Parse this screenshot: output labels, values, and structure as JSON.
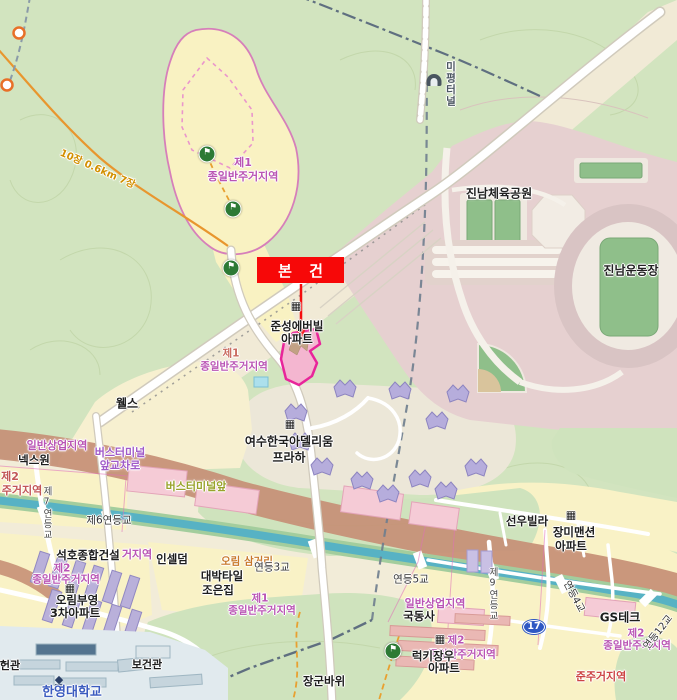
{
  "annotation": {
    "label": "본 건"
  },
  "map": {
    "colors": {
      "callout_red": "#f70808",
      "parcel_highlight_fill": "#f4b6d0",
      "parcel_highlight_border": "#e8259a",
      "zone_label_pink": "#b954b4",
      "commercial_band_brown": "#c69076",
      "stream_teal": "#57b2c4",
      "route_badge_blue": "#2f58c3",
      "forest_green": "#d2e4bf",
      "park_pink": "#e6d0d0"
    },
    "icons": {
      "flag": "⚑",
      "building": "▦",
      "tunnel": "",
      "school": "◆"
    },
    "route_badge": {
      "text": "17",
      "x": 534,
      "y": 627
    },
    "labels": [
      {
        "n": "zone-label",
        "t": "제1",
        "x": 243,
        "y": 163,
        "s": 11,
        "c": "#b954b4",
        "b": 1
      },
      {
        "n": "zone-label",
        "t": "종일반주거지역",
        "x": 243,
        "y": 177,
        "s": 11,
        "c": "#b954b4",
        "b": 1
      },
      {
        "n": "poi-jinnam-sports-park",
        "t": "진남체육공원",
        "x": 499,
        "y": 194,
        "s": 12,
        "c": "#222",
        "b": 1
      },
      {
        "n": "poi-jinnam-stadium",
        "t": "진남운동장",
        "x": 631,
        "y": 271,
        "s": 12,
        "c": "#222",
        "b": 1
      },
      {
        "n": "road-mipyeong-tunnel",
        "t": "미평터널",
        "x": 450,
        "y": 84,
        "s": 10.5,
        "c": "#4a5560",
        "b": 1,
        "v": 1
      },
      {
        "n": "trail-distance-label",
        "t": "10장 0.6km 7장",
        "x": 97,
        "y": 170,
        "s": 10,
        "c": "#d29000",
        "b": 1,
        "r": 24
      },
      {
        "n": "poi-junseong-everville",
        "t": "준성에버빌",
        "x": 297,
        "y": 326,
        "s": 11.5,
        "c": "#1d1d1d",
        "b": 1
      },
      {
        "n": "poi-junseong-everville",
        "t": "아파트",
        "x": 297,
        "y": 339,
        "s": 11.5,
        "c": "#1d1d1d",
        "b": 1
      },
      {
        "n": "zone-label",
        "t": "제1",
        "x": 231,
        "y": 354,
        "s": 10.5,
        "c": "#c96a5e",
        "b": 1
      },
      {
        "n": "zone-label",
        "t": "종일반주거지역",
        "x": 234,
        "y": 367,
        "s": 10.5,
        "c": "#b954b4",
        "b": 1
      },
      {
        "n": "poi-wells",
        "t": "웰스",
        "x": 127,
        "y": 404,
        "s": 12,
        "c": "#1d1d1d",
        "b": 1
      },
      {
        "n": "poi-adellium-praha",
        "t": "여수한국아델리움",
        "x": 289,
        "y": 442,
        "s": 12,
        "c": "#1d1d1d",
        "b": 1
      },
      {
        "n": "poi-adellium-praha",
        "t": "프라하",
        "x": 289,
        "y": 458,
        "s": 12,
        "c": "#1d1d1d",
        "b": 1
      },
      {
        "n": "zone-label",
        "t": "일반상업지역",
        "x": 57,
        "y": 446,
        "s": 11,
        "c": "#b954b4",
        "b": 1
      },
      {
        "n": "poi-nexone",
        "t": "넥스원",
        "x": 34,
        "y": 460,
        "s": 11.5,
        "c": "#1d1d1d",
        "b": 1
      },
      {
        "n": "intersection-bus-terminal",
        "t": "버스터미널",
        "x": 120,
        "y": 453,
        "s": 11,
        "c": "#a05ac8",
        "b": 1
      },
      {
        "n": "intersection-bus-terminal",
        "t": "앞교차로",
        "x": 120,
        "y": 466,
        "s": 11,
        "c": "#a05ac8",
        "b": 1
      },
      {
        "n": "busstop-bus-terminal-front",
        "t": "버스터미널앞",
        "x": 196,
        "y": 487,
        "s": 11,
        "c": "#99a32b",
        "b": 1
      },
      {
        "n": "zone-label",
        "t": "제2",
        "x": 10,
        "y": 477,
        "s": 11,
        "c": "#c25555",
        "b": 1
      },
      {
        "n": "zone-label",
        "t": "주거지역",
        "x": 22,
        "y": 491,
        "s": 11,
        "c": "#c25555",
        "b": 1
      },
      {
        "n": "bridge-jereyeondeung-6",
        "t": "제6연등교",
        "x": 109,
        "y": 521,
        "s": 10.5,
        "c": "#333"
      },
      {
        "n": "poi-seokho-construction",
        "t": "석호종합건설",
        "x": 88,
        "y": 555,
        "s": 11.5,
        "c": "#1d1d1d",
        "b": 1
      },
      {
        "n": "zone-label",
        "t": "거지역",
        "x": 137,
        "y": 555,
        "s": 11,
        "c": "#b954b4",
        "b": 1
      },
      {
        "n": "poi-incellderm",
        "t": "인셀덤",
        "x": 172,
        "y": 559,
        "s": 11.5,
        "c": "#1d1d1d",
        "b": 1
      },
      {
        "n": "zone-label",
        "t": "제2",
        "x": 62,
        "y": 569,
        "s": 10.5,
        "c": "#b954b4",
        "b": 1
      },
      {
        "n": "zone-label",
        "t": "종일반주거지역",
        "x": 66,
        "y": 580,
        "s": 10.5,
        "c": "#b954b4",
        "b": 1
      },
      {
        "n": "poi-orim-booyoung-apt",
        "t": "오림부영",
        "x": 77,
        "y": 600,
        "s": 11.5,
        "c": "#1d1d1d",
        "b": 1
      },
      {
        "n": "poi-orim-booyoung-apt",
        "t": "3차아파트",
        "x": 75,
        "y": 613,
        "s": 11.5,
        "c": "#1d1d1d",
        "b": 1
      },
      {
        "n": "poi-daebak-tile",
        "t": "대박타일",
        "x": 222,
        "y": 576,
        "s": 11.5,
        "c": "#1d1d1d",
        "b": 1
      },
      {
        "n": "poi-daebak-tile",
        "t": "조은집",
        "x": 218,
        "y": 590,
        "s": 11.5,
        "c": "#1d1d1d",
        "b": 1
      },
      {
        "n": "intersection-orim",
        "t": "오림 삼거리",
        "x": 247,
        "y": 562,
        "s": 10.5,
        "c": "#c87828",
        "b": 1
      },
      {
        "n": "bridge-yeondeung-3",
        "t": "연등3교",
        "x": 272,
        "y": 568,
        "s": 10.5,
        "c": "#333"
      },
      {
        "n": "bridge-yeondeung-5",
        "t": "연등5교",
        "x": 411,
        "y": 580,
        "s": 10.5,
        "c": "#333"
      },
      {
        "n": "zone-label",
        "t": "제1",
        "x": 260,
        "y": 599,
        "s": 10.5,
        "c": "#b954b4",
        "b": 1
      },
      {
        "n": "zone-label",
        "t": "종일반주거지역",
        "x": 262,
        "y": 611,
        "s": 10.5,
        "c": "#b954b4",
        "b": 1
      },
      {
        "n": "zone-label",
        "t": "일반상업지역",
        "x": 435,
        "y": 604,
        "s": 11,
        "c": "#b954b4",
        "b": 1
      },
      {
        "n": "poi-gukdongsa",
        "t": "국동사",
        "x": 419,
        "y": 616,
        "s": 11.5,
        "c": "#1d1d1d",
        "b": 1
      },
      {
        "n": "zone-label",
        "t": "제2",
        "x": 456,
        "y": 641,
        "s": 10.5,
        "c": "#b954b4",
        "b": 1
      },
      {
        "n": "zone-label",
        "t": "종일반주거지역",
        "x": 462,
        "y": 655,
        "s": 10.5,
        "c": "#b954b4",
        "b": 1
      },
      {
        "n": "poi-lucky-apt",
        "t": "럭키장우",
        "x": 433,
        "y": 656,
        "s": 11.5,
        "c": "#1d1d1d",
        "b": 1
      },
      {
        "n": "poi-lucky-apt",
        "t": "아파트",
        "x": 444,
        "y": 668,
        "s": 11.5,
        "c": "#1d1d1d",
        "b": 1
      },
      {
        "n": "poi-gs-tech",
        "t": "GS테크",
        "x": 620,
        "y": 618,
        "s": 12,
        "c": "#1d1d1d",
        "b": 1
      },
      {
        "n": "poi-seonwoo-villa",
        "t": "선우빌라",
        "x": 527,
        "y": 521,
        "s": 11.5,
        "c": "#1d1d1d",
        "b": 1
      },
      {
        "n": "poi-rose-mansion",
        "t": "장미맨션",
        "x": 574,
        "y": 532,
        "s": 11.5,
        "c": "#1d1d1d",
        "b": 1
      },
      {
        "n": "poi-rose-mansion",
        "t": "아파트",
        "x": 571,
        "y": 546,
        "s": 11.5,
        "c": "#1d1d1d",
        "b": 1
      },
      {
        "n": "poi-janggun-rock",
        "t": "장군바위",
        "x": 324,
        "y": 681,
        "s": 11.5,
        "c": "#1d1d1d",
        "b": 1
      },
      {
        "n": "poi-bogeongwan",
        "t": "보건관",
        "x": 147,
        "y": 665,
        "s": 11,
        "c": "#1d1d1d",
        "b": 1
      },
      {
        "n": "poi-heongwan",
        "t": "헌관",
        "x": 10,
        "y": 666,
        "s": 11,
        "c": "#1d1d1d",
        "b": 1
      },
      {
        "n": "poi-hanyeong-university",
        "t": "한영대학교",
        "x": 72,
        "y": 693,
        "s": 13,
        "c": "#3b5bbf",
        "b": 1
      },
      {
        "n": "zone-label",
        "t": "제2",
        "x": 636,
        "y": 634,
        "s": 10.5,
        "c": "#b954b4",
        "b": 1
      },
      {
        "n": "zone-label",
        "t": "종일반주거지역",
        "x": 637,
        "y": 646,
        "s": 10.5,
        "c": "#b954b4",
        "b": 1
      },
      {
        "n": "bridge-yeondeung-4",
        "t": "연등4교",
        "x": 573,
        "y": 597,
        "s": 10,
        "c": "#333",
        "r": 62
      },
      {
        "n": "bridge-yeondeung-12",
        "t": "연등12교",
        "x": 659,
        "y": 633,
        "s": 10,
        "c": "#333",
        "r": -52
      },
      {
        "n": "zone-label",
        "t": "준주거지역",
        "x": 601,
        "y": 677,
        "s": 11,
        "c": "#cc4444",
        "b": 1
      },
      {
        "n": "bridge-jereyeondeung-7",
        "t": "제7연등교",
        "x": 46,
        "y": 513,
        "s": 9.5,
        "c": "#444",
        "v": 1
      },
      {
        "n": "bridge-jereyeondeung-9",
        "t": "제9연등교",
        "x": 492,
        "y": 594,
        "s": 9.5,
        "c": "#444",
        "v": 1
      }
    ],
    "markers": [
      {
        "type": "flag",
        "n": "hiking-flag-marker",
        "x": 207,
        "y": 154
      },
      {
        "type": "flag",
        "n": "hiking-flag-marker",
        "x": 233,
        "y": 209
      },
      {
        "type": "flag",
        "n": "hiking-flag-marker",
        "x": 231,
        "y": 268
      },
      {
        "type": "flag",
        "n": "hiking-flag-marker",
        "x": 393,
        "y": 651
      },
      {
        "type": "building",
        "n": "apartment-icon",
        "x": 296,
        "y": 306
      },
      {
        "type": "building",
        "n": "apartment-icon",
        "x": 290,
        "y": 424
      },
      {
        "type": "building",
        "n": "apartment-icon",
        "x": 571,
        "y": 515
      },
      {
        "type": "building",
        "n": "apartment-icon",
        "x": 440,
        "y": 639
      },
      {
        "type": "building",
        "n": "apartment-icon",
        "x": 70,
        "y": 588
      },
      {
        "type": "tunnel",
        "n": "tunnel-icon",
        "x": 434,
        "y": 80
      },
      {
        "type": "school",
        "n": "university-icon",
        "x": 59,
        "y": 681
      }
    ]
  }
}
